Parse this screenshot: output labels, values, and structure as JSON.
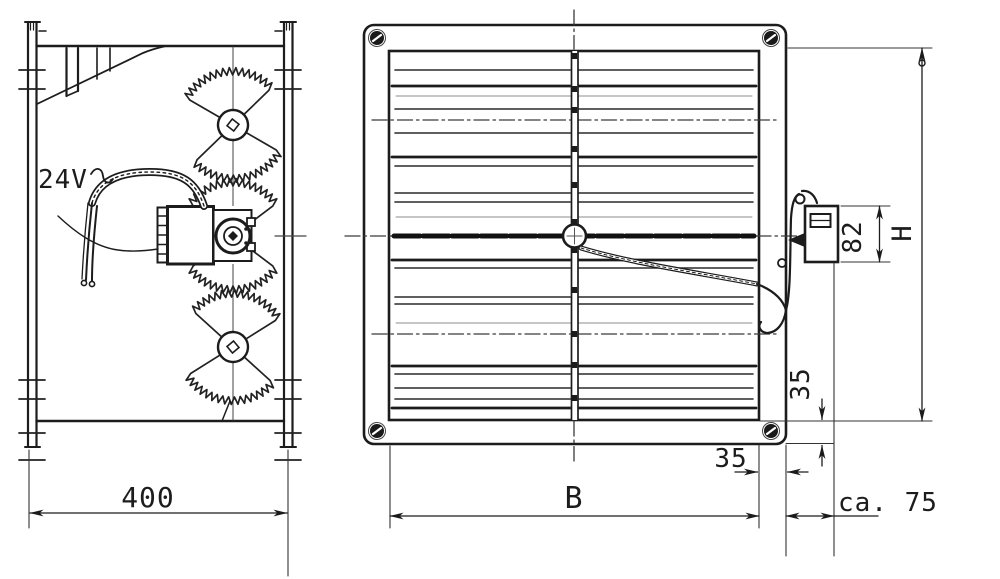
{
  "drawing": {
    "type": "technical-drawing",
    "ink_color": "#1c1c1c",
    "background_color": "#ffffff",
    "side_view": {
      "annotations": {
        "supply_voltage": "24V"
      },
      "dimensions": {
        "frame_width": "400"
      }
    },
    "front_view": {
      "dimensions": {
        "blade_width": "B",
        "frame_height": "H",
        "actuator_height": "82",
        "flange_side": "35",
        "flange_bottom": "35",
        "actuator_depth": "ca. 75"
      }
    }
  }
}
